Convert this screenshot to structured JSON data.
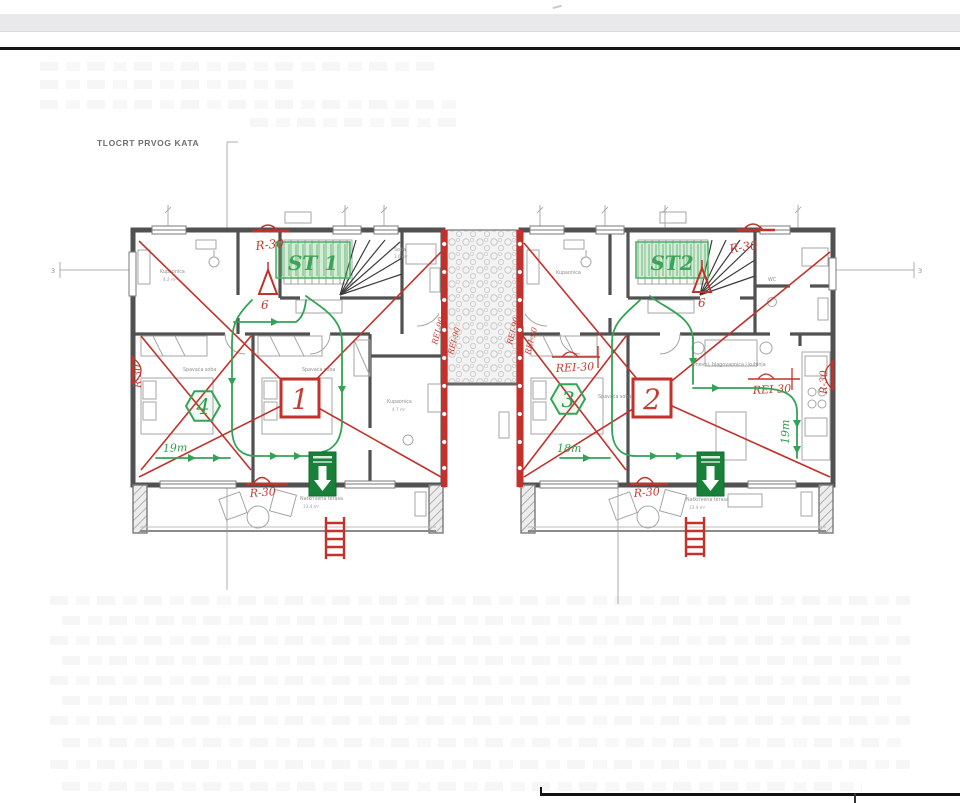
{
  "page": {
    "title": "TLOCRT PRVOG KATA"
  },
  "colors": {
    "fire_red": "#c2322a",
    "escape_green": "#2f9e4e",
    "exit_green": "#188038",
    "wall_gray": "#515151",
    "firewall_red": "#c6302a"
  },
  "axes": {
    "left_mark": "3",
    "right_mark": "3"
  },
  "firewalls": {
    "label": "REI-90"
  },
  "units": [
    {
      "stair_label": "ST 1",
      "unit_number": "1",
      "room_badge": "4",
      "evac_minutes": "6",
      "escape_distance": "19m",
      "rating_top": "R-30",
      "rating_bottom": "R-30",
      "rating_side": "R-30",
      "rooms": {
        "bath_top": {
          "name": "Kupaonica",
          "area": "4.2 m²"
        },
        "soba": {
          "name": "Soba",
          "area": "3.6 m²"
        },
        "bedroom_left": {
          "name": "Spavaća soba"
        },
        "bedroom_mid": {
          "name": "Spavaća soba"
        },
        "bath_right": {
          "name": "Kupaonica",
          "area": "4.7 m²"
        },
        "terrace": {
          "name": "Natkrivena terasa",
          "area": "13.4 m²"
        }
      }
    },
    {
      "stair_label": "ST2",
      "unit_number": "2",
      "room_badge": "3",
      "evac_minutes": "6",
      "escape_distance": "18m",
      "escape_distance_side": "19m",
      "rating_top": "R-30",
      "rating_bottom": "R-30",
      "rating_side": "R-30",
      "rei_left": "REI-30",
      "rei_right": "REI-30",
      "rooms": {
        "bath_top": {
          "name": "Kupaonica"
        },
        "wc": {
          "name": "WC"
        },
        "bedroom": {
          "name": "Spavaća soba"
        },
        "living": {
          "name": "Dnevni, blagovaonica i kuhinja"
        },
        "terrace": {
          "name": "Natkrivena terasa",
          "area": "13.4 m²"
        }
      }
    }
  ]
}
